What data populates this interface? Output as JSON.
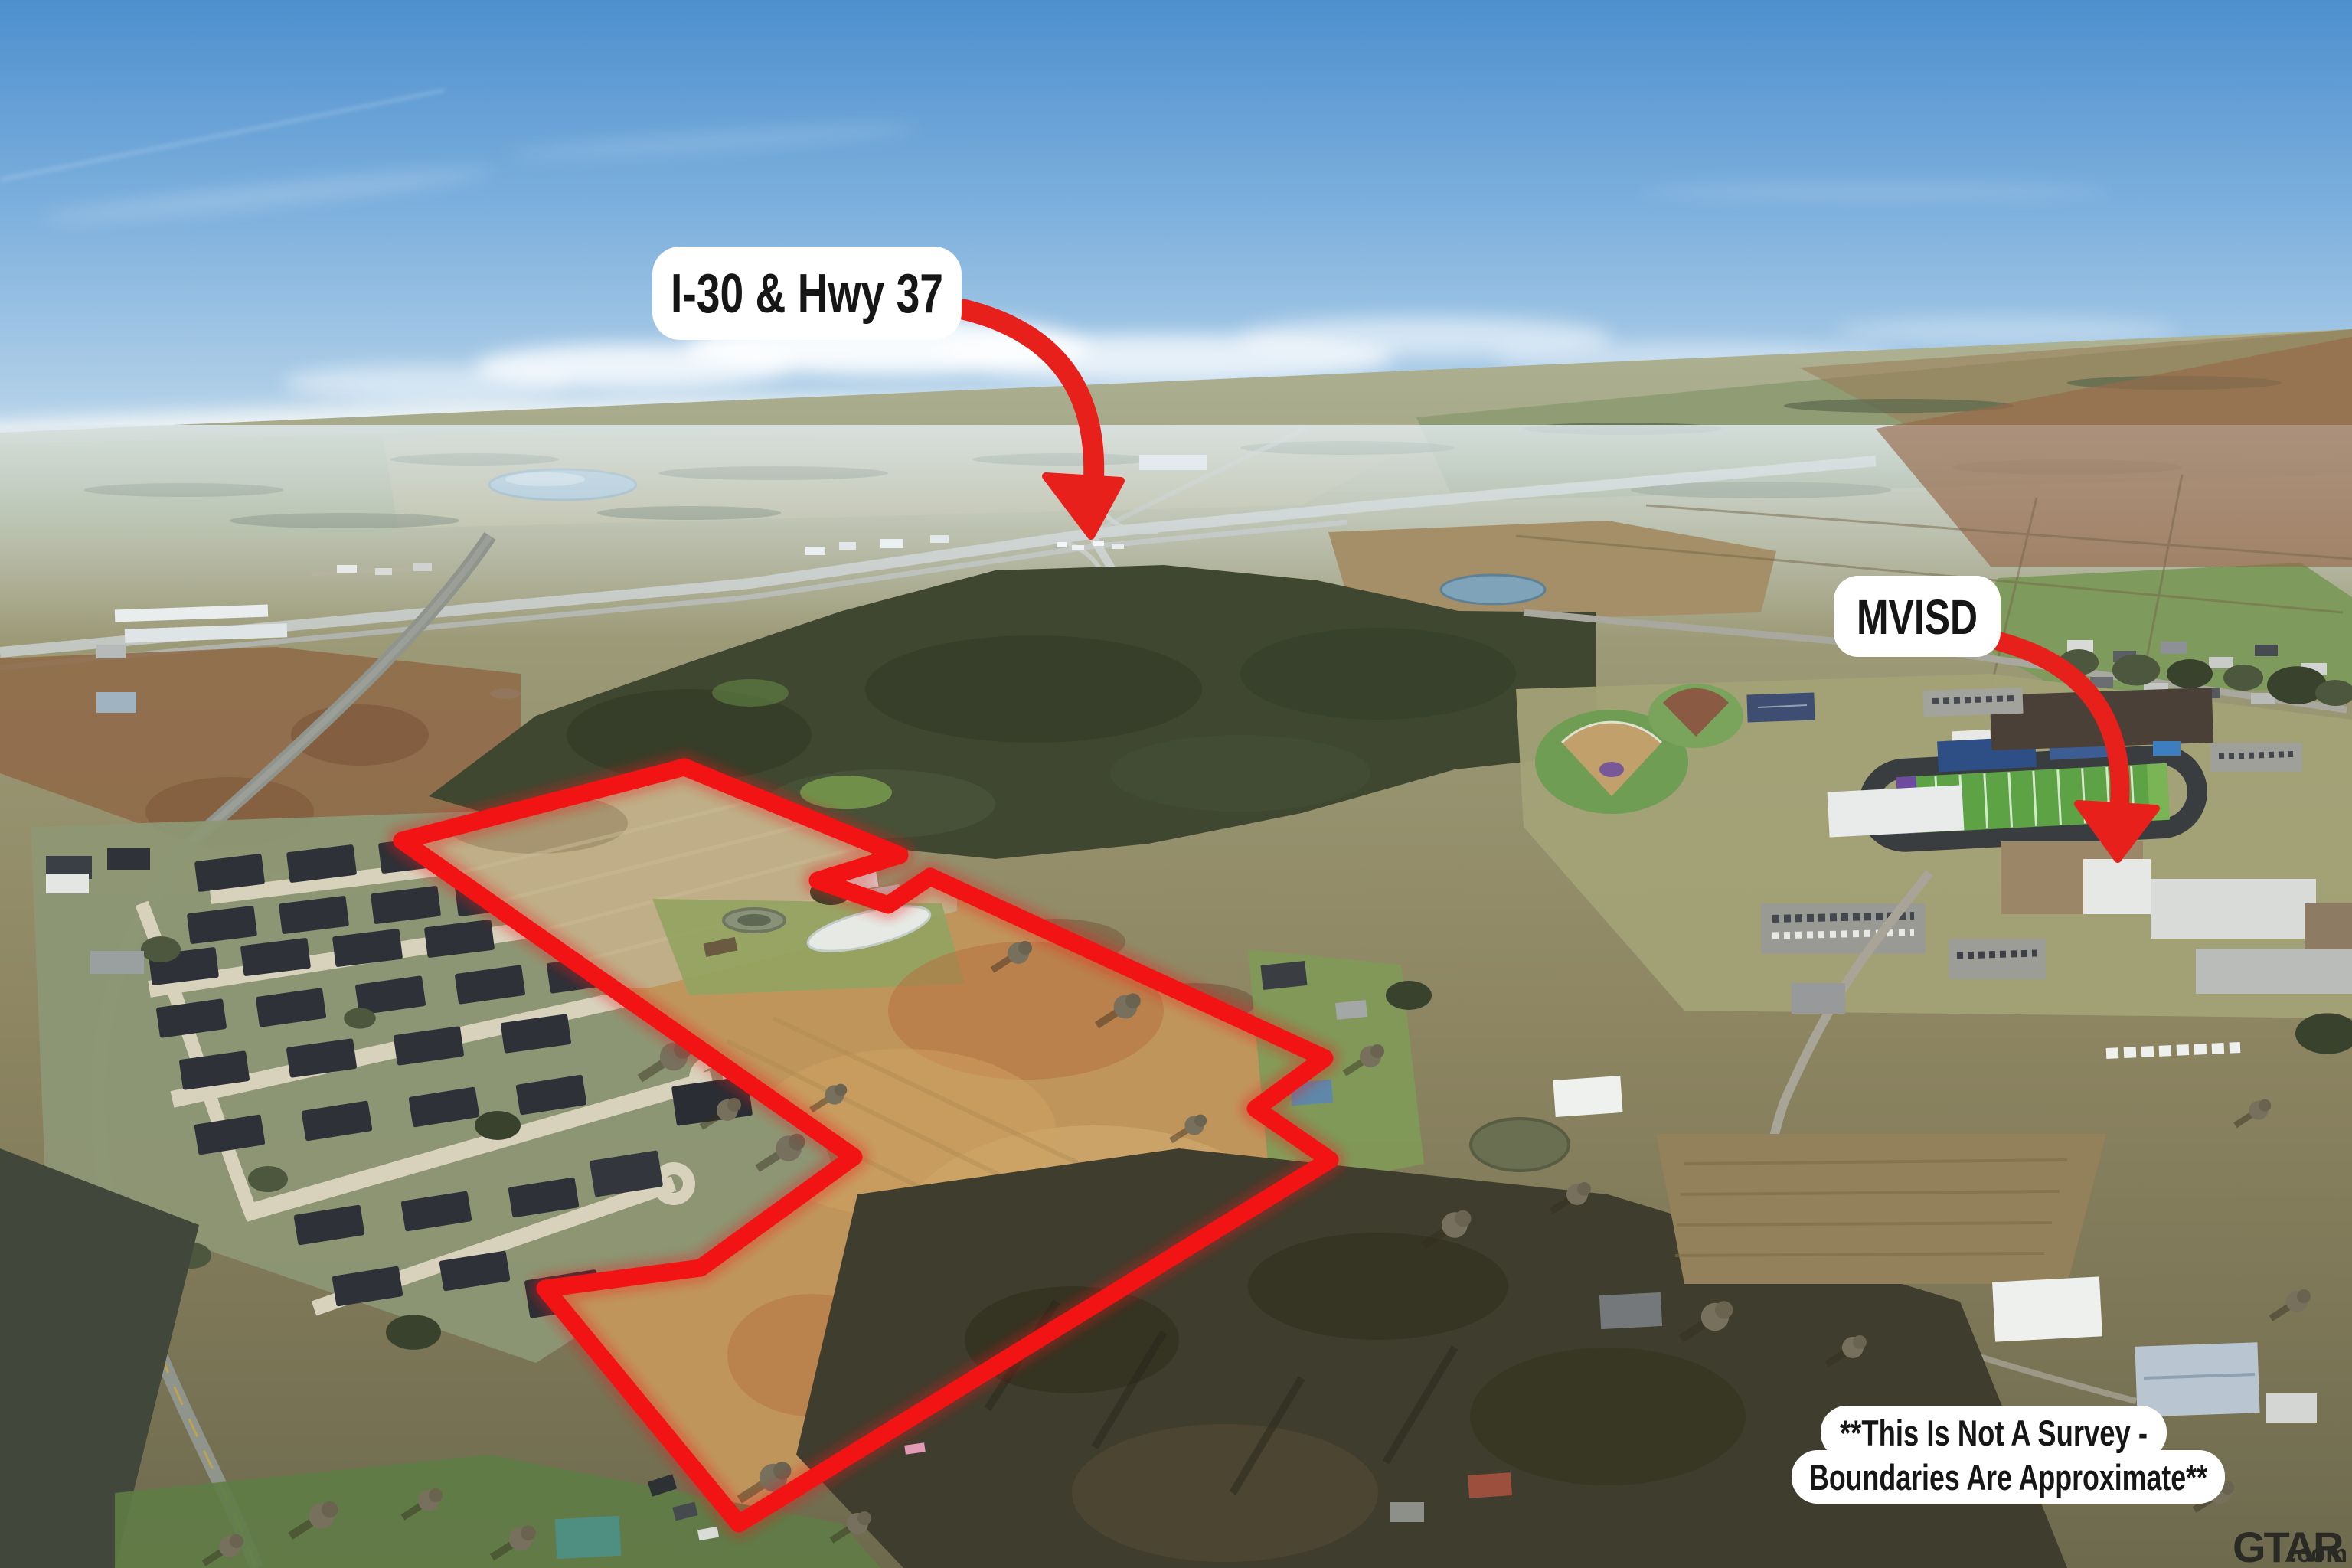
{
  "annotations": {
    "highway_label": "I-30 & Hwy 37",
    "school_label": "MVISD",
    "disclaimer_line1": "**This Is Not A Survey -",
    "disclaimer_line2": "Boundaries Are Approximate**",
    "watermark_brand": "GTAR",
    "watermark_suffix": ".com"
  },
  "colors": {
    "boundary_red": "#f21414",
    "arrow_red": "#e8201c",
    "label_background": "#ffffff",
    "label_text": "#161616",
    "watermark_color": "#1c1c1c"
  }
}
